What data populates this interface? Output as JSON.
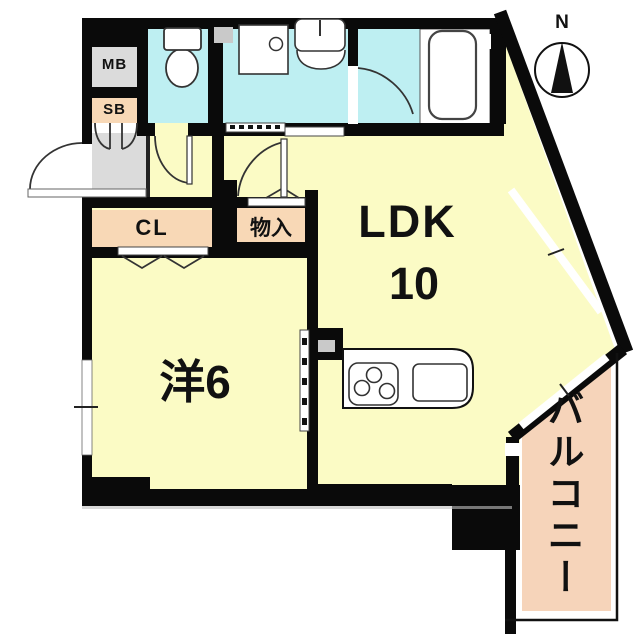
{
  "title": "apartment-floor-plan",
  "labels": {
    "mb": "MB",
    "sb": "SB",
    "cl": "CL",
    "storage": "物入",
    "ldk": "LDK",
    "ldk_size": "10",
    "western_room": "洋6",
    "balcony": "バルコニー",
    "north": "N"
  },
  "colors": {
    "room_yellow": "#FBFBC5",
    "wet_cyan": "#BEEFF2",
    "closet_peach": "#F8D8B6",
    "balcony_peach": "#F6D4BA",
    "entry_gray": "#DBDBDB",
    "accent_gray": "#C9C9C9",
    "wall_black": "#0A0A0A",
    "line": "#333333"
  }
}
